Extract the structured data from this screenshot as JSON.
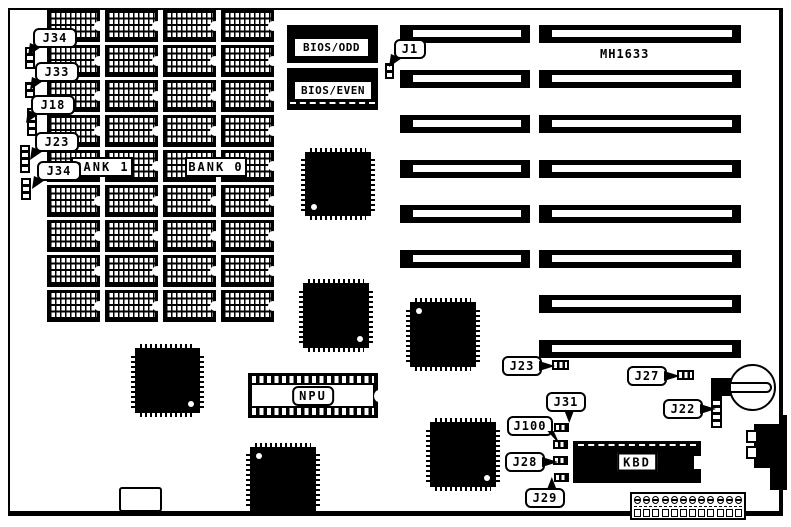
{
  "board_label": "MH1633",
  "chip_labels": {
    "bios_odd": "BIOS/ODD",
    "bios_even": "BIOS/EVEN",
    "npu": "NPU",
    "kbd": "KBD"
  },
  "bank_labels": {
    "bank1": "BANK 1",
    "bank0": "BANK 0"
  },
  "callouts": {
    "j34_top": "J34",
    "j33": "J33",
    "j18": "J18",
    "j23_left": "J23",
    "j34_mid": "J34",
    "j1": "J1",
    "j23_center": "J23",
    "j27": "J27",
    "j31": "J31",
    "j100": "J100",
    "j28": "J28",
    "j29": "J29",
    "j22": "J22"
  },
  "memory_array": {
    "rows": 9,
    "cols": 4,
    "bank_count": 2
  },
  "expansion_slots": {
    "total": 8,
    "with_short_segment": 6
  },
  "power_connector": {
    "pin_count": 12
  },
  "colors": {
    "ink": "#000000",
    "paper": "#ffffff"
  }
}
